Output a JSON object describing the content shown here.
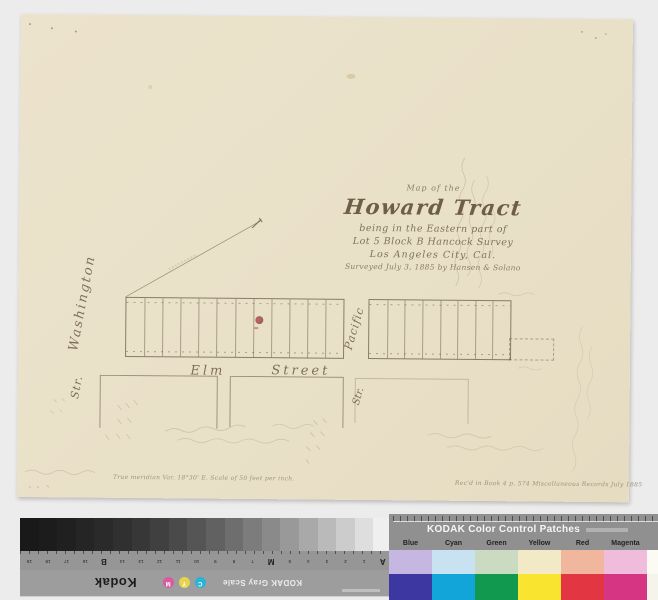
{
  "map": {
    "title": {
      "line1": "Map of the",
      "line2": "Howard Tract",
      "line3": "being in the Eastern part of",
      "line4": "Lot 5 Block B Hancock Survey",
      "line5": "Los Angeles City, Cal.",
      "line6": "Surveyed July 3, 1885 by Hansen & Solano"
    },
    "streets": {
      "washington": "Washington",
      "washington_suffix": "Str.",
      "elm_word1": "Elm",
      "elm_word2": "Street",
      "pacific": "Pacific",
      "pacific_suffix": "Str."
    },
    "captions": {
      "bottom_left": "True meridian Var. 18°30' E.    Scale of 50 feet per inch.",
      "bottom_right": "Rec'd in Book 4 p. 574 Miscellaneous Records July 1885"
    },
    "plat": {
      "lots_left": 12,
      "lots_right": 8
    },
    "stamp_color": "#8c3b3b"
  },
  "gray_scale": {
    "brand": "Kodak",
    "label": "KODAK Gray Scale",
    "steps": [
      "#191919",
      "#1c1c1c",
      "#202020",
      "#252525",
      "#2a2a2a",
      "#303030",
      "#373737",
      "#404040",
      "#4a4a4a",
      "#555555",
      "#616161",
      "#6e6e6e",
      "#7c7c7c",
      "#8a8a8a",
      "#999999",
      "#a9a9a9",
      "#bababa",
      "#cccccc",
      "#dedede",
      "#efefef"
    ],
    "index_labels": [
      "A",
      "1",
      "2",
      "3",
      "4",
      "5",
      "M",
      "7",
      "8",
      "9",
      "10",
      "11",
      "12",
      "13",
      "14",
      "B",
      "16",
      "17",
      "18",
      "19"
    ],
    "dots": [
      {
        "letter": "C",
        "color": "#2ab3d6"
      },
      {
        "letter": "Y",
        "color": "#e8d44c"
      },
      {
        "letter": "M",
        "color": "#d95aa0"
      }
    ]
  },
  "color_patches": {
    "title": "KODAK Color Control Patches",
    "columns": [
      {
        "label": "Blue",
        "light": "#c6b6e2",
        "dark": "#3d37a1"
      },
      {
        "label": "Cyan",
        "light": "#c8e2f1",
        "dark": "#12a5d9"
      },
      {
        "label": "Green",
        "light": "#cbdbc2",
        "dark": "#119a4f"
      },
      {
        "label": "Yellow",
        "light": "#f2eac6",
        "dark": "#f9e530"
      },
      {
        "label": "Red",
        "light": "#f1b69e",
        "dark": "#e23742"
      },
      {
        "label": "Magenta",
        "light": "#f0bcdb",
        "dark": "#d53582"
      },
      {
        "label": "White",
        "light": "#fbfaf3",
        "dark": "#f4f3ec"
      }
    ]
  }
}
